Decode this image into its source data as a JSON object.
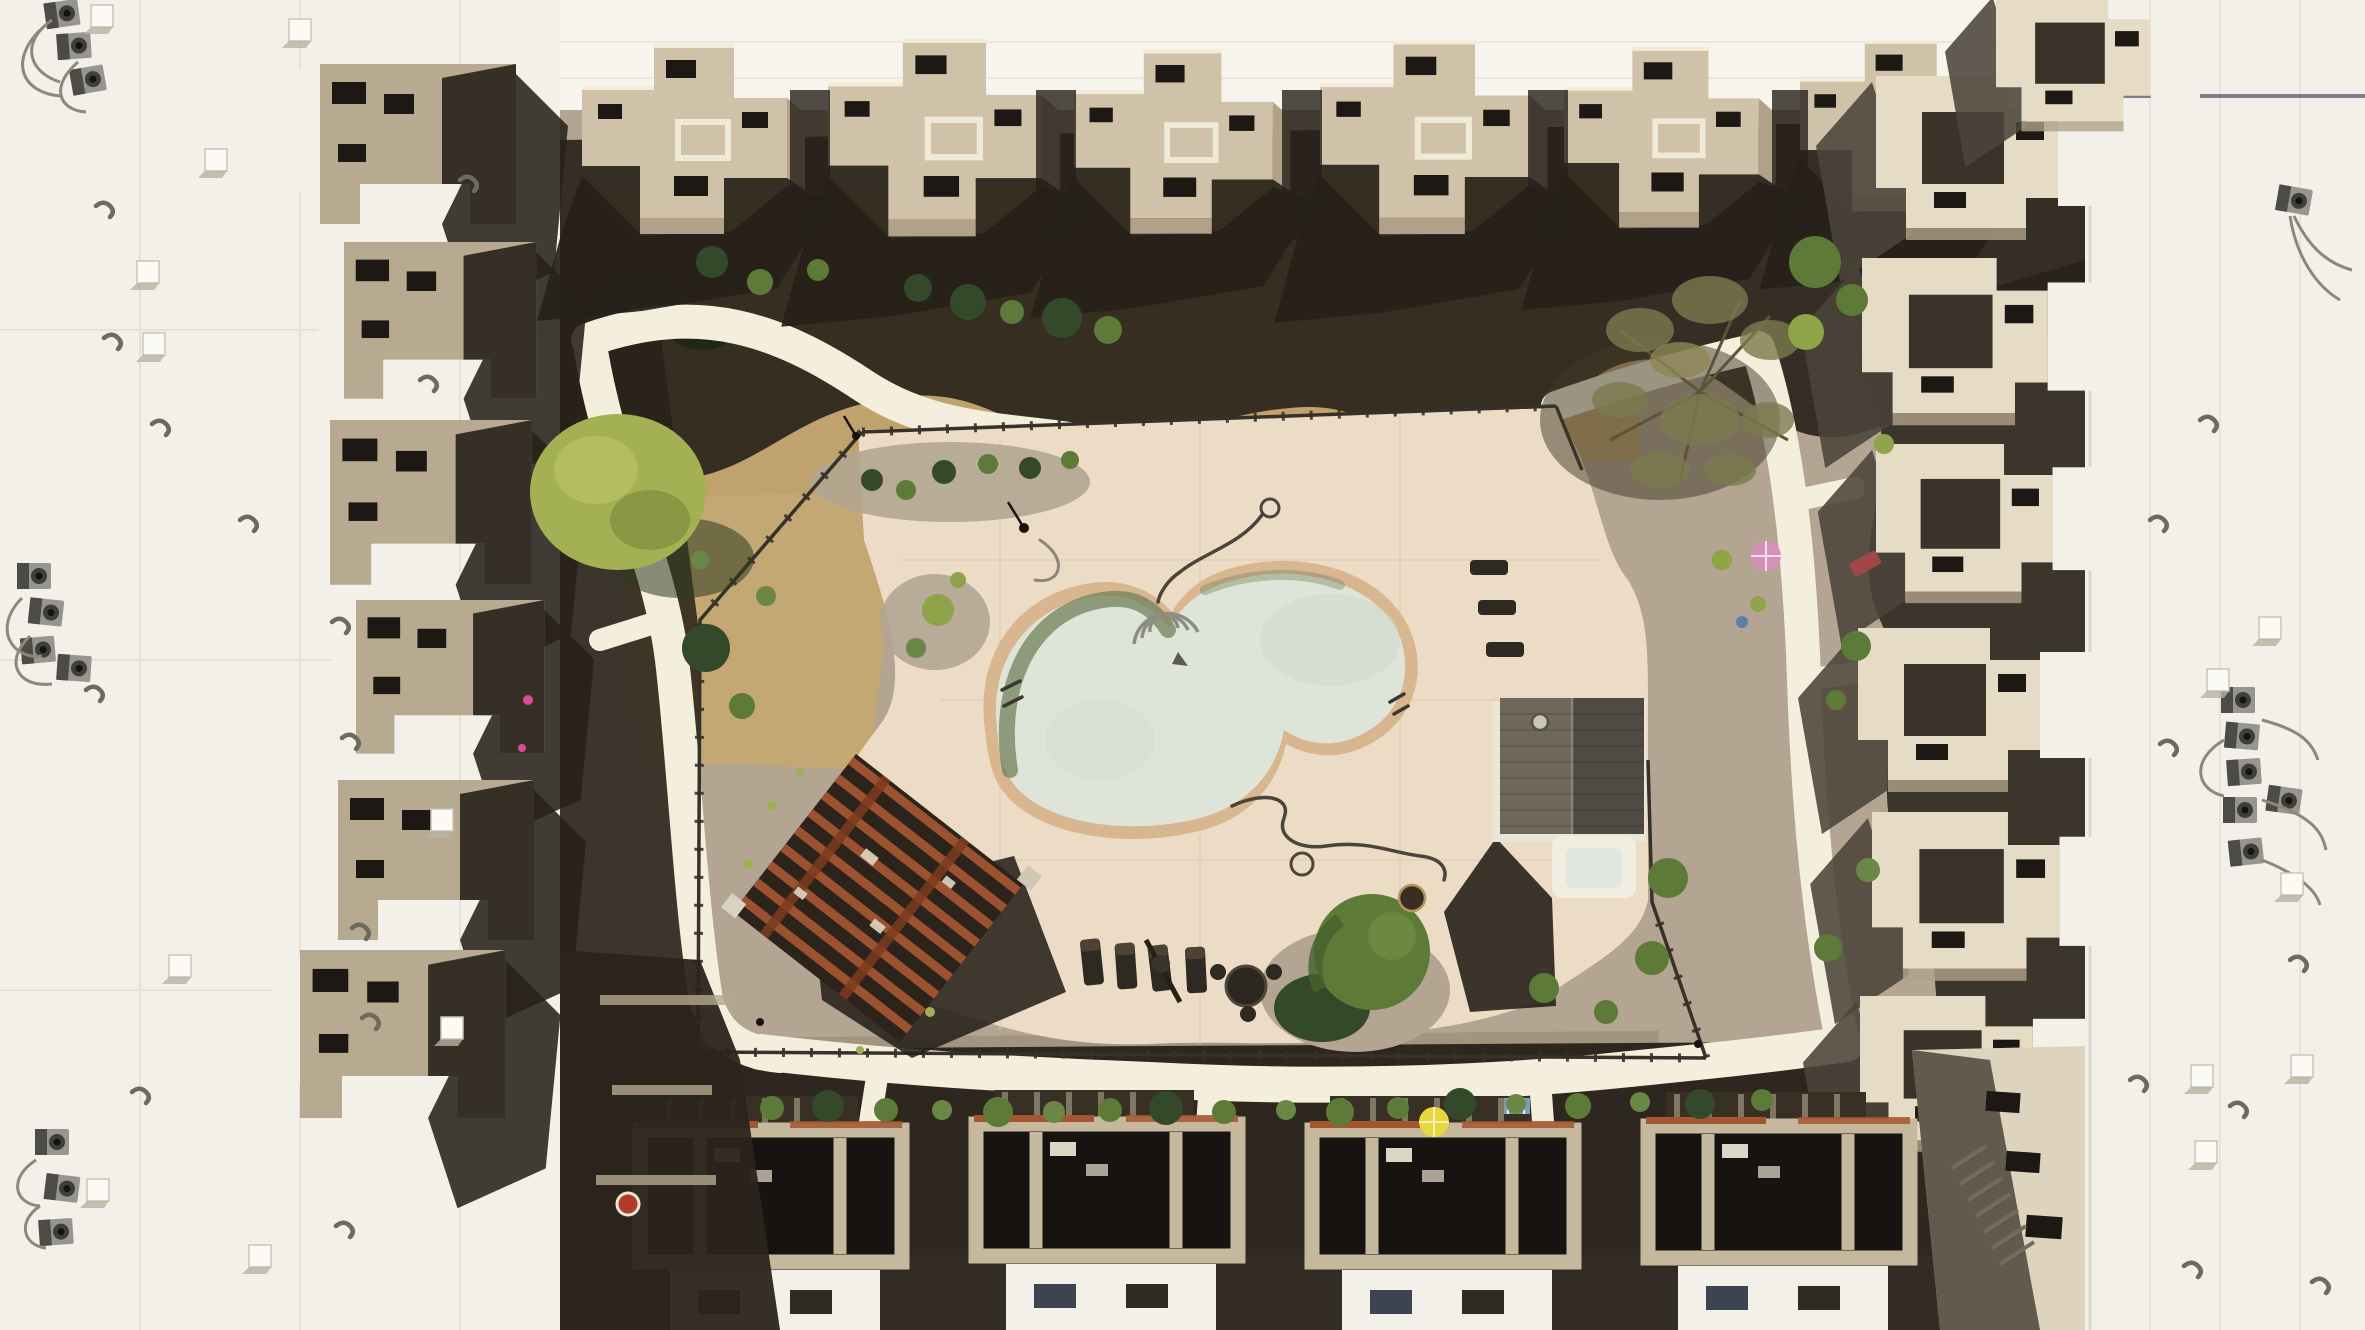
{
  "scene": {
    "title": "Aerial drone view of a southwestern condominium complex courtyard",
    "description": "Top-down view of flat white rooftops and stepped adobe-style buildings enclosing a landscaped courtyard with a freeform swimming pool, spa building, rust-wood pergola, curving white concrete walkways, desert plantings and poolside furniture under hard midday sun",
    "sun": "hard light from upper right; shadows cast toward lower left"
  },
  "palette": {
    "roof": "#f2f0e9",
    "band": "#f6f4ed",
    "seam": "#d9d5c7",
    "suntan": "#cfc2a8",
    "midtan": "#b0a188",
    "cream": "#e6dcc5",
    "shadow": "#27211a",
    "shsoft": "#4b443a",
    "deck": "#ecdcc6",
    "dirt": "#c0a26c",
    "dirtlight": "#ccb07c",
    "gravel": "#b3a591",
    "graveldk": "#a2947e",
    "path": "#f4eedd",
    "coping": "#d8b68f",
    "water": "#dee5d8",
    "watershadow": "#72815c",
    "fence": "#37312a",
    "rust": "#9c5230",
    "pergdark": "#2c241b",
    "treebright": "#a3b154",
    "treegreen": "#5d7a38",
    "treedark": "#33492a",
    "treeolive": "#7c7a4e",
    "ac": "#97968e",
    "acdark": "#3f3e3a",
    "vent": "#fbfaf5",
    "terra": "#a3562f",
    "upink": "#d990b8",
    "uyellow": "#e5d83d",
    "red": "#b33b2e",
    "furn": "#2e2921",
    "poolroofL": "#6e675a",
    "poolroofR": "#4f4a42",
    "spa": "#dfe7de"
  },
  "features": {
    "pool": {
      "shape": "freeform dog-bone",
      "water": "pale milky green",
      "coping": "tan tile",
      "handrails": 2,
      "step_arcs": 3,
      "cleaning_hoses": 2
    },
    "spa": {
      "rim": "white rounded square",
      "water": "pale blue-green"
    },
    "pool_house": {
      "roof": "dark brown gable with vent cap"
    },
    "pergola": {
      "type": "rust-red wood lattice square, rotated",
      "shadow": "cast to southeast"
    },
    "walkways": {
      "color": "white concrete",
      "layout": "loop around courtyard with building spurs"
    },
    "furniture": {
      "pool_lounge_chairs": 4,
      "deck_edge_chairs": 3,
      "round_table_sets": 1,
      "fire_pit": 1
    },
    "umbrellas": {
      "pink": 1,
      "yellow": 1
    },
    "vegetation": {
      "bright_green_tree": 1,
      "sparse_olive_tree": 1,
      "round_green_tree": 1,
      "shrubs": "40+ mounded desert shrubs"
    },
    "rooftop_equipment": {
      "ac_unit_clusters": 5,
      "white_box_vents": 15,
      "pipe_vents": "20+"
    },
    "buildings": {
      "style": "stepped pueblo blocks, tan stucco",
      "balconies": "with patio furniture",
      "bottom_row": "walled patios with slatted shade structures"
    }
  }
}
